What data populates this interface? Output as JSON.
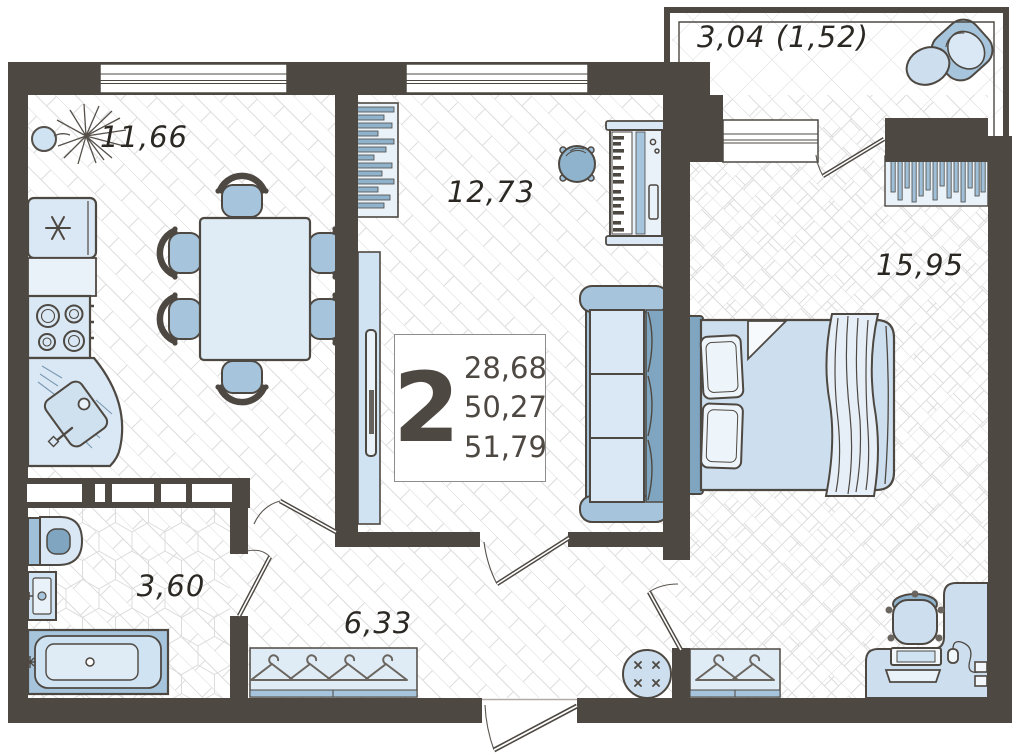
{
  "summary": {
    "rooms_label": "2",
    "area_values": [
      "28,68",
      "50,27",
      "51,79"
    ]
  },
  "rooms": {
    "kitchen": {
      "label": "11,66"
    },
    "living_room": {
      "label": "12,73"
    },
    "bedroom": {
      "label": "15,95"
    },
    "bathroom": {
      "label": "3,60"
    },
    "hallway": {
      "label": "6,33"
    },
    "balcony": {
      "label": "3,04 (1,52)"
    }
  },
  "palette": {
    "wall": "#4e4842",
    "furniture_light": "#d9e8f4",
    "furniture_lighter": "#e9f2f9",
    "furniture_medium": "#a6c4db",
    "furniture_deep": "#7fa5c0",
    "floor_hatch": "#dcdcdc",
    "label_text": "#2b2824",
    "info_border": "#8d8d8d"
  }
}
